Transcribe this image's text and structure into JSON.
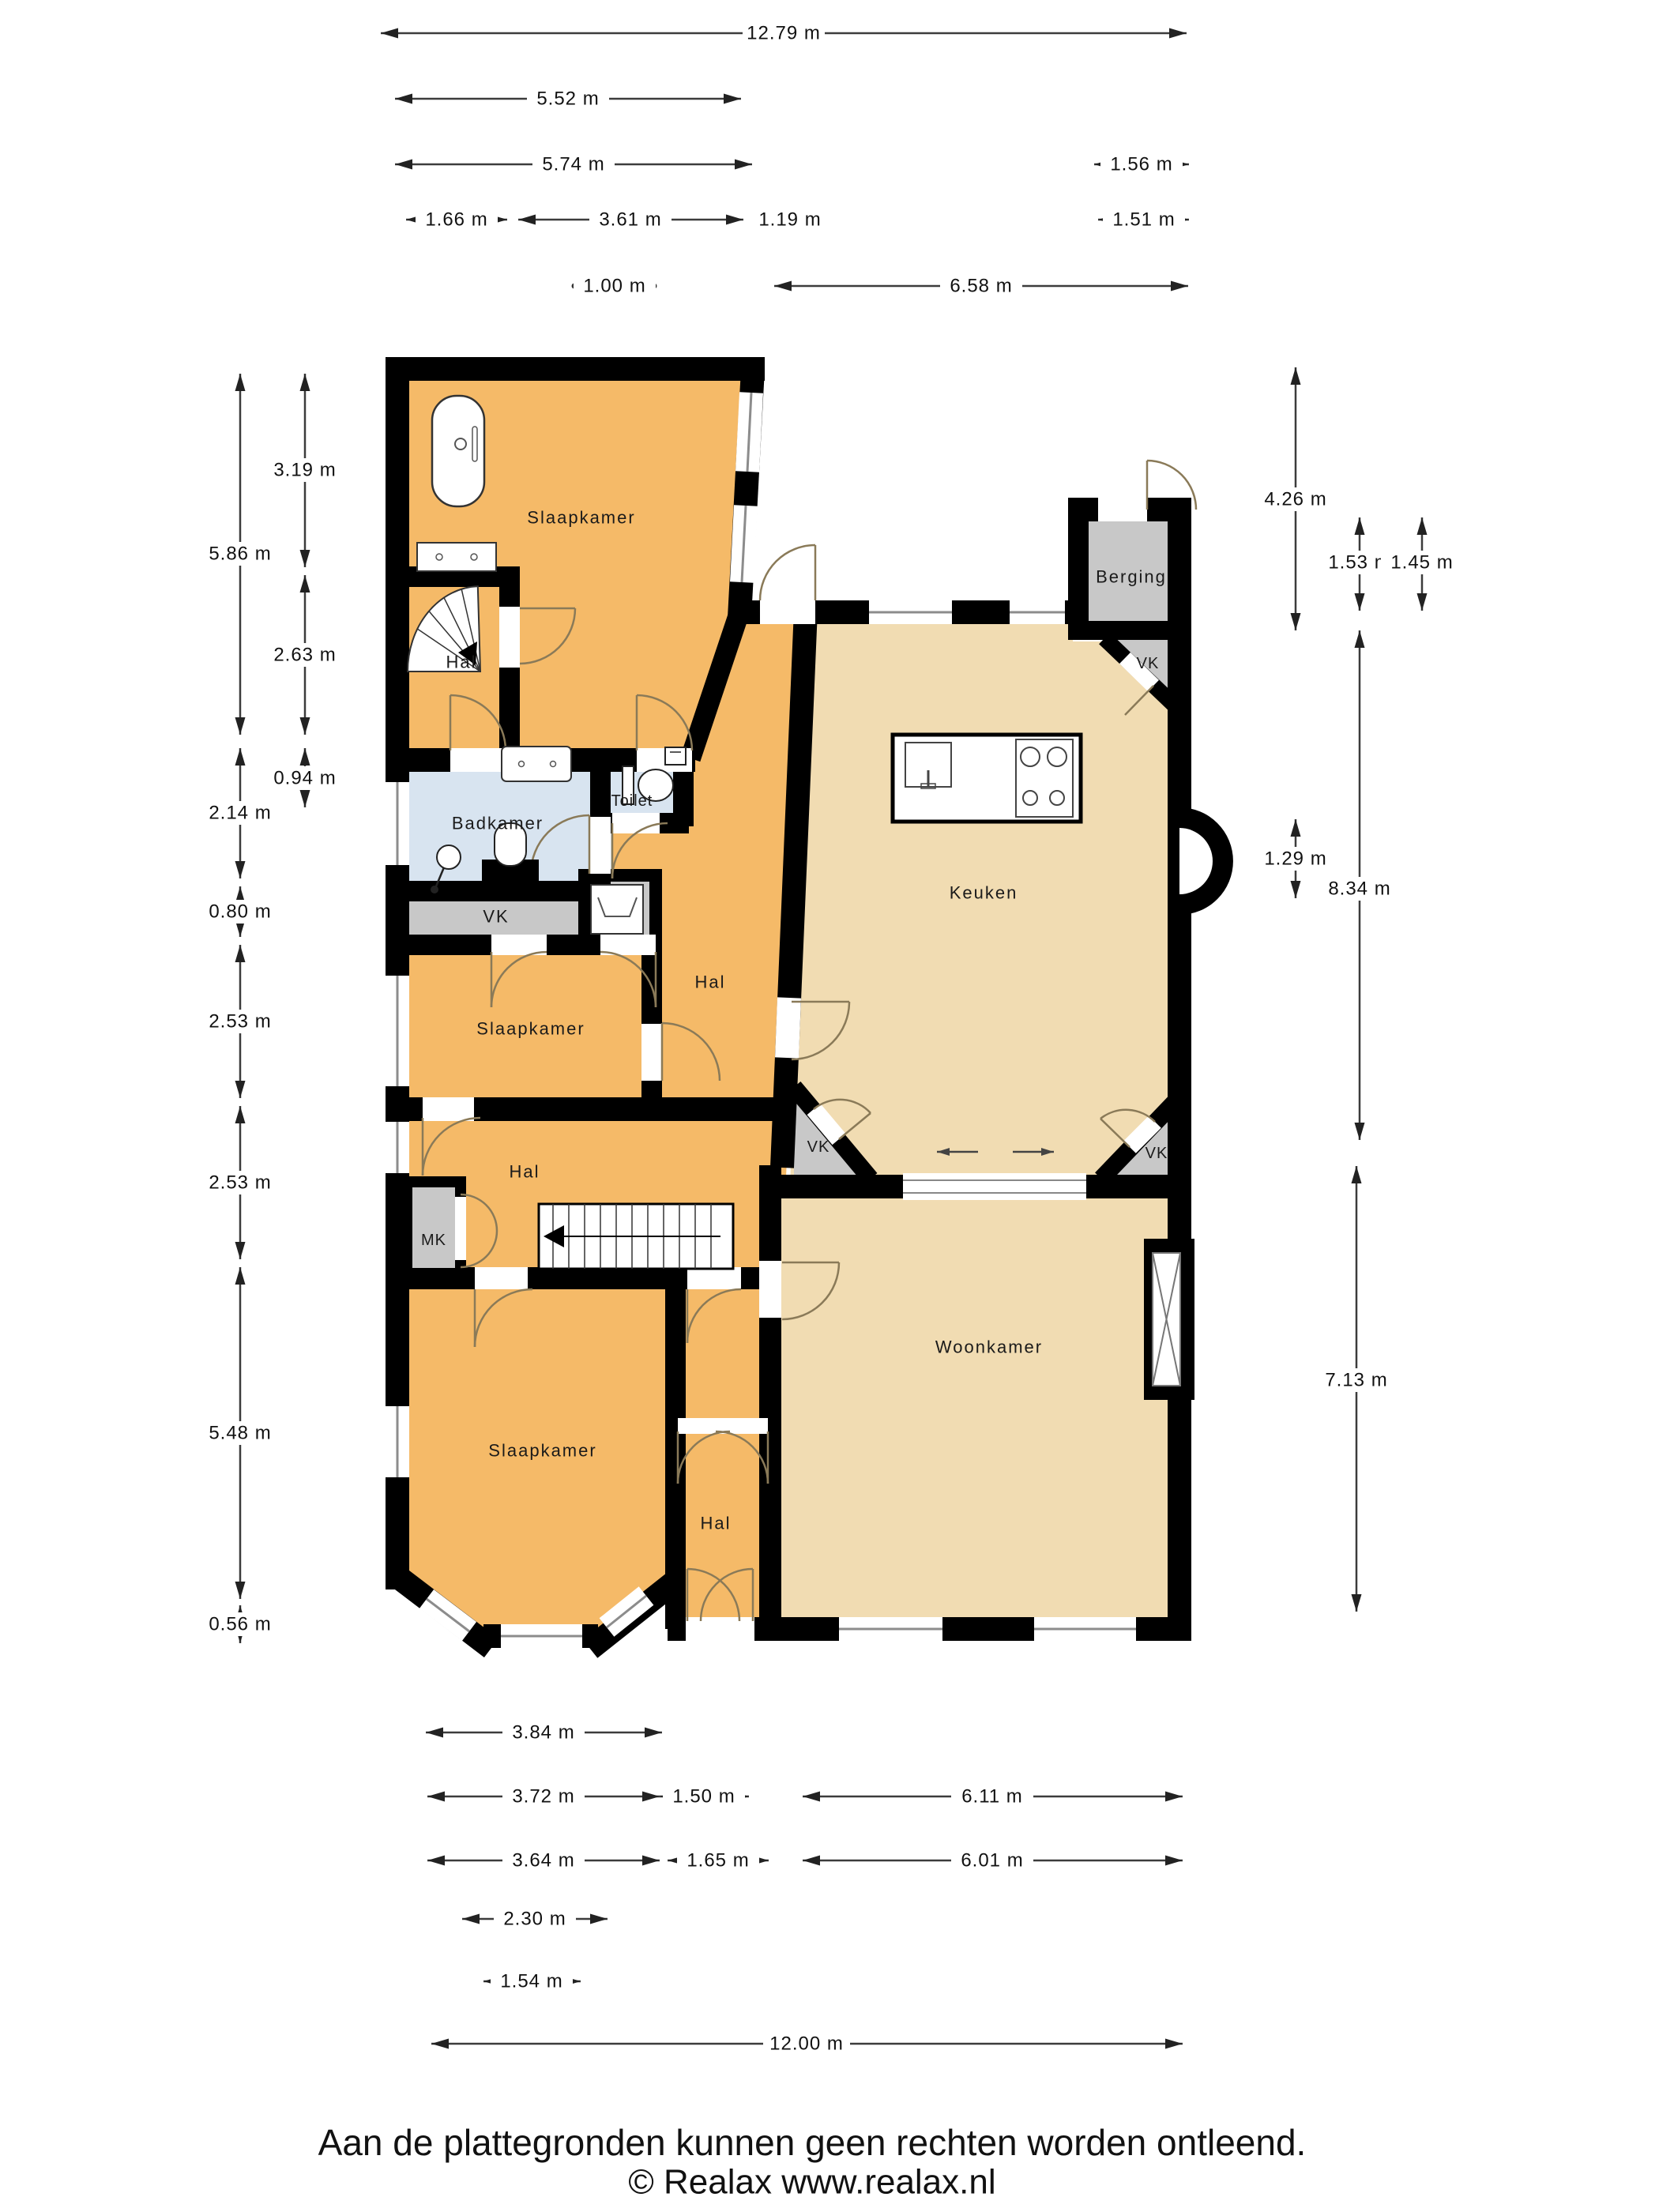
{
  "plan": {
    "colors": {
      "orange": "#F5BA68",
      "tan": "#F1DCB2",
      "blue": "#D8E4F0",
      "gray": "#C8C8C8",
      "wall": "#000000",
      "door_arc": "#8a7a58",
      "window_line": "#8c8c8c"
    },
    "rooms": [
      {
        "id": "slaapkamer-top",
        "label": "Slaapkamer"
      },
      {
        "id": "hal-top",
        "label": "Hal"
      },
      {
        "id": "badkamer",
        "label": "Badkamer"
      },
      {
        "id": "toilet",
        "label": "Toilet"
      },
      {
        "id": "vk-left",
        "label": "VK"
      },
      {
        "id": "slaapkamer-mid",
        "label": "Slaapkamer"
      },
      {
        "id": "hal-diagonal",
        "label": "Hal"
      },
      {
        "id": "hal-mid",
        "label": "Hal"
      },
      {
        "id": "mk",
        "label": "MK"
      },
      {
        "id": "slaapkamer-bottom",
        "label": "Slaapkamer"
      },
      {
        "id": "hal-bottom",
        "label": "Hal"
      },
      {
        "id": "keuken",
        "label": "Keuken"
      },
      {
        "id": "berging",
        "label": "Berging"
      },
      {
        "id": "vk-berging",
        "label": "VK"
      },
      {
        "id": "vk-woonkamer-left",
        "label": "VK"
      },
      {
        "id": "vk-woonkamer-right",
        "label": "VK"
      },
      {
        "id": "woonkamer",
        "label": "Woonkamer"
      }
    ],
    "dimensions": {
      "top": [
        "12.79 m",
        "5.52 m",
        "5.74 m",
        "1.56 m",
        "1.66 m",
        "3.61 m",
        "1.19 m",
        "1.51 m",
        "1.00 m",
        "6.58 m"
      ],
      "left": [
        "3.19 m",
        "5.86 m",
        "2.63 m",
        "0.94 m",
        "2.14 m",
        "0.80 m",
        "2.53 m",
        "2.53 m",
        "5.48 m",
        "0.56 m"
      ],
      "right": [
        "4.26 m",
        "1.53 m",
        "1.45 m",
        "8.34 m",
        "1.29 m",
        "7.13 m"
      ],
      "bottom": [
        "3.84 m",
        "3.72 m",
        "1.50 m",
        "6.11 m",
        "3.64 m",
        "1.65 m",
        "6.01 m",
        "2.30 m",
        "1.54 m",
        "12.00 m"
      ]
    },
    "footer": {
      "disclaimer": "Aan de plattegronden kunnen geen rechten worden ontleend.",
      "copyright": "© Realax www.realax.nl"
    }
  }
}
